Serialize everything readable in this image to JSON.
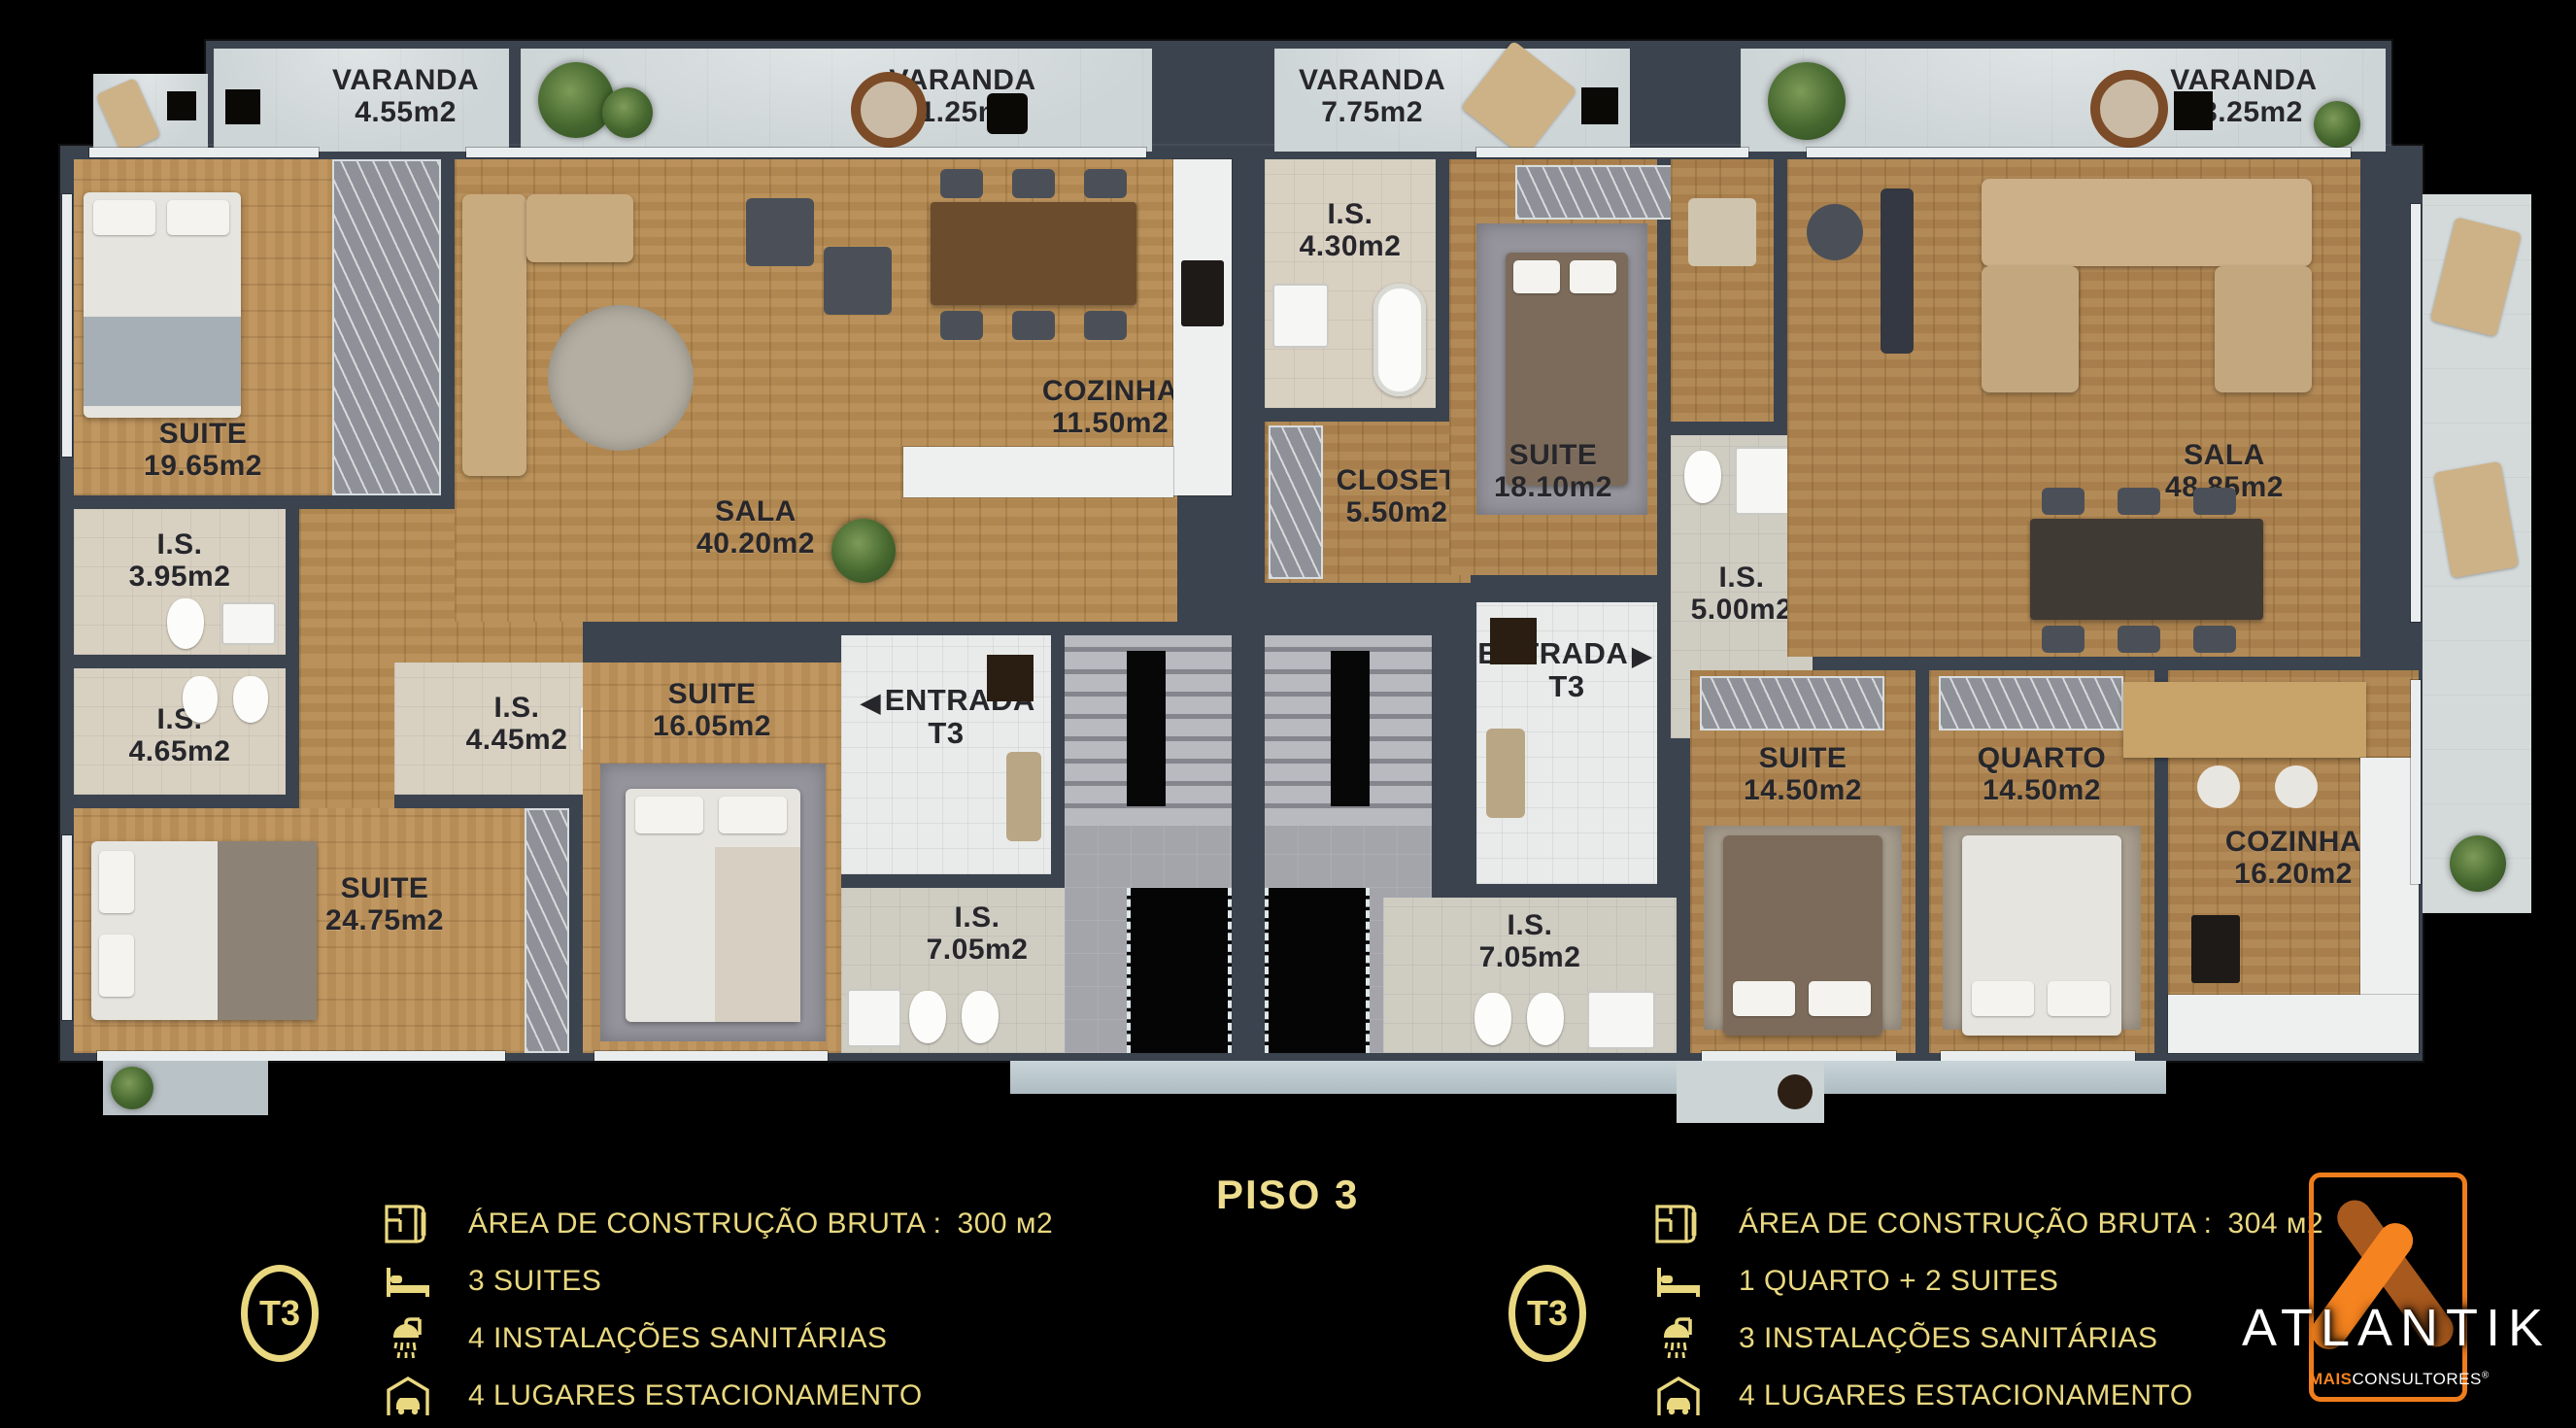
{
  "title": {
    "floor_label": "PISO 3"
  },
  "colors": {
    "accent_gold": "#E9D87F",
    "brand_orange": "#F5831F",
    "brand_orange_dark": "#A8591D",
    "wall": "#3A434E",
    "wood": "#B68C54",
    "background": "#000000"
  },
  "plan": {
    "varandas": [
      {
        "name": "VARANDA",
        "area": "4.55m2"
      },
      {
        "name": "VARANDA",
        "area": "11.25m2"
      },
      {
        "name": "VARANDA",
        "area": "7.75m2"
      },
      {
        "name": "VARANDA",
        "area": "23.25m2"
      }
    ],
    "apartment_left": {
      "rooms": [
        {
          "name": "SUITE",
          "area": "19.65m2"
        },
        {
          "name": "I.S.",
          "area": "3.95m2"
        },
        {
          "name": "I.S.",
          "area": "4.65m2"
        },
        {
          "name": "SUITE",
          "area": "24.75m2"
        },
        {
          "name": "I.S.",
          "area": "4.45m2"
        },
        {
          "name": "SUITE",
          "area": "16.05m2"
        },
        {
          "name": "SALA",
          "area": "40.20m2"
        },
        {
          "name": "COZINHA",
          "area": "11.50m2"
        },
        {
          "name": "ENTRADA",
          "area": "T3",
          "arrow": "◀"
        },
        {
          "name": "I.S.",
          "area": "7.05m2"
        }
      ]
    },
    "apartment_right": {
      "rooms": [
        {
          "name": "I.S.",
          "area": "4.30m2"
        },
        {
          "name": "CLOSET",
          "area": "5.50m2"
        },
        {
          "name": "SUITE",
          "area": "18.10m2"
        },
        {
          "name": "I.S.",
          "area": "5.00m2"
        },
        {
          "name": "SALA",
          "area": "48.85m2"
        },
        {
          "name": "ENTRADA",
          "area": "T3",
          "arrow": "▶"
        },
        {
          "name": "I.S.",
          "area": "7.05m2"
        },
        {
          "name": "SUITE",
          "area": "14.50m2"
        },
        {
          "name": "QUARTO",
          "area": "14.50m2"
        },
        {
          "name": "COZINHA",
          "area": "16.20m2"
        }
      ]
    }
  },
  "legend_left": {
    "badge": "T3",
    "items": [
      {
        "icon": "floor-plan-icon",
        "text": "ÁREA DE CONSTRUÇÃO BRUTA :",
        "value": "300 м2"
      },
      {
        "icon": "bed-icon",
        "text": "3 SUITES",
        "value": ""
      },
      {
        "icon": "shower-icon",
        "text": "4 INSTALAÇÕES SANITÁRIAS",
        "value": ""
      },
      {
        "icon": "car-garage-icon",
        "text": "4 LUGARES ESTACIONAMENTO",
        "value": ""
      }
    ]
  },
  "legend_right": {
    "badge": "T3",
    "items": [
      {
        "icon": "floor-plan-icon",
        "text": "ÁREA DE CONSTRUÇÃO BRUTA :",
        "value": "304 м2"
      },
      {
        "icon": "bed-icon",
        "text": "1 QUARTO + 2 SUITES",
        "value": ""
      },
      {
        "icon": "shower-icon",
        "text": "3 INSTALAÇÕES SANITÁRIAS",
        "value": ""
      },
      {
        "icon": "car-garage-icon",
        "text": "4 LUGARES ESTACIONAMENTO",
        "value": ""
      }
    ]
  },
  "brand": {
    "name": "ATLANTIK",
    "sub_bold": "MAIS",
    "sub_rest": "CONSULTORES",
    "registered": "®"
  }
}
